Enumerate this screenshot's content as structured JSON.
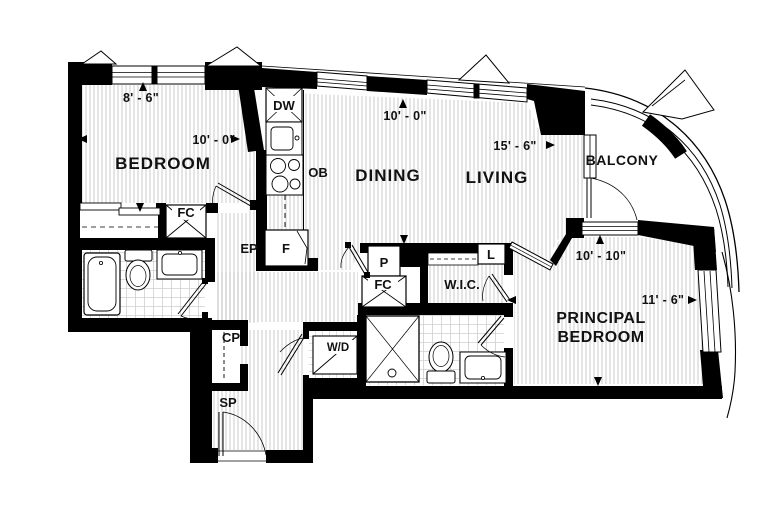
{
  "plan": {
    "title": "2-bedroom apartment floor plan",
    "rooms": {
      "bedroom": "BEDROOM",
      "dining": "DINING",
      "living": "LIVING",
      "balcony": "BALCONY",
      "principal_line1": "PRINCIPAL",
      "principal_line2": "BEDROOM",
      "wic": "W.I.C."
    },
    "labels": {
      "dishwasher": "DW",
      "oven": "OB",
      "fridge": "F",
      "fan_coil_1": "FC",
      "fan_coil_2": "FC",
      "electrical_panel": "EP",
      "pantry": "P",
      "linen": "L",
      "coat_closet": "CP",
      "sprinkler": "SP",
      "washer_dryer": "W/D"
    },
    "dimensions": {
      "bedroom_width": "8' - 6\"",
      "bedroom_length": "10' - 0\"",
      "dining_depth": "10' - 0\"",
      "living_length": "15' - 6\"",
      "principal_depth": "10' - 10\"",
      "principal_length": "11' - 6\""
    },
    "colors": {
      "wall": "#000000",
      "hatch": "#b9b9b9",
      "tile": "#cfcfcf",
      "background": "#ffffff",
      "text": "#111111"
    }
  }
}
